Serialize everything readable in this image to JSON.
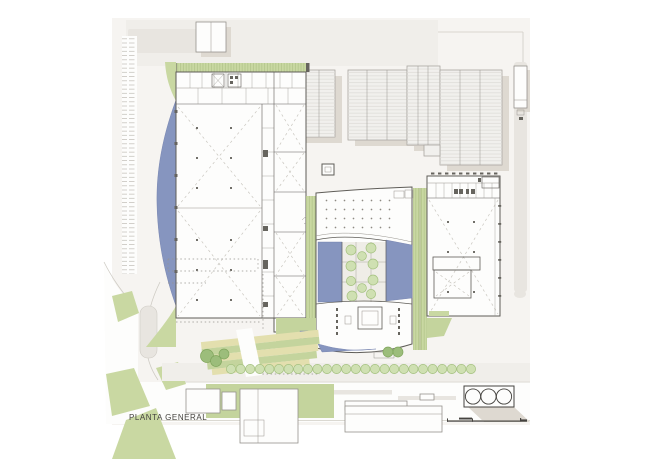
{
  "title": "PLANTA GENERAL",
  "drawing": {
    "kind": "architectural site plan",
    "label": "PLANTA GENERAL"
  },
  "colors": {
    "page": "#ffffff",
    "ground": "#f6f4f1",
    "ground-2": "#f0eeea",
    "plot": "#e8e5e0",
    "paper": "#fdfdfc",
    "shadow": "#ded9d1",
    "context": "#f1f0ed",
    "context-outline": "#a9a6a0",
    "rib": "#dcdad6",
    "wall": "#5f5d58",
    "inner": "#97948e",
    "brace": "#c9c6bf",
    "dot": "#8e8b83",
    "column-dot": "#716f69",
    "dark-mark": "#66645e",
    "tick": "#c9c6c0",
    "curb": "#cfccc5",
    "ink": "#45433f",
    "veg": "#c9d8a2",
    "veg-hatch": "#a9bd83",
    "lawn": "#c4d49d",
    "tree": "#cfe0b2",
    "tree-stroke": "#a3c07e",
    "bush": "#9cbd7b",
    "bush-stroke": "#7fa55c",
    "blue": "#8695bf",
    "blue-stroke": "#6c7aa8",
    "tan": "#e3dfae",
    "outline-2": "#95928c"
  }
}
